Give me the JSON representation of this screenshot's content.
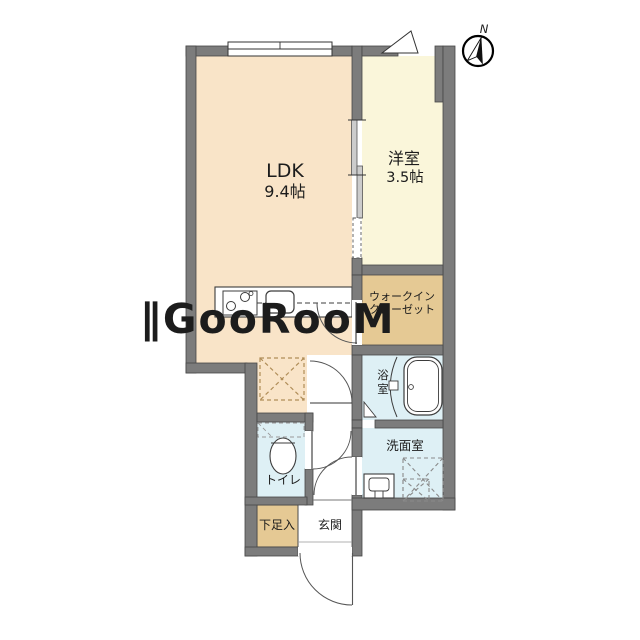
{
  "plan": {
    "rooms": {
      "ldk": {
        "name": "LDK",
        "size": "9.4帖"
      },
      "bedroom": {
        "name": "洋室",
        "size": "3.5帖"
      },
      "walk_in_closet": {
        "name_line1": "ウォークイン",
        "name_line2": "クローゼット"
      },
      "bathroom": {
        "name_char1": "浴",
        "name_char2": "室"
      },
      "washroom": {
        "name": "洗面室"
      },
      "toilet": {
        "name": "トイレ"
      },
      "shoe_storage": {
        "name": "下足入"
      },
      "entrance": {
        "name": "玄関"
      }
    },
    "compass": {
      "north_label": "N"
    },
    "watermark": {
      "text": "∥GooRooM"
    },
    "colors": {
      "wall": "#7c7c7c",
      "wall_outline": "#474747",
      "ldk_floor": "#f9e4c8",
      "bedroom_floor": "#faf6da",
      "closet_floor": "#e5c994",
      "wet_floor": "#def0f5",
      "fixture_line": "#3c3c3c",
      "watermark": "rgba(255,255,255,0.62)"
    }
  }
}
